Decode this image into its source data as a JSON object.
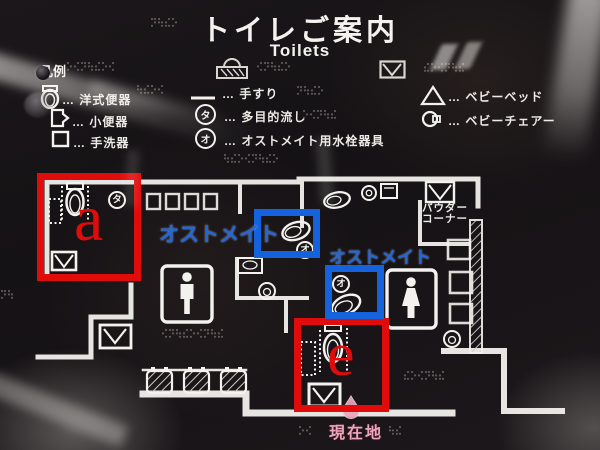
{
  "sign": {
    "title": "トイレご案内",
    "subtitle": "Toilets",
    "legend": {
      "heading": "凡例",
      "left_items": [
        {
          "icon": "western-toilet-icon",
          "label": "… 洋式便器"
        },
        {
          "icon": "urinal-icon",
          "label": "… 小便器"
        },
        {
          "icon": "hand-basin-icon",
          "label": "… 手洗器"
        }
      ],
      "middle_items": [
        {
          "icon": "handrail-icon",
          "label": "… 手すり"
        },
        {
          "icon": "multipurpose-sink-icon",
          "symbol": "タ",
          "label": "… 多目的流し"
        },
        {
          "icon": "ostomate-fixture-icon",
          "symbol": "オ",
          "label": "… オストメイト用水栓器具"
        }
      ],
      "right_items": [
        {
          "icon": "baby-bed-icon",
          "label": "… ベビーベッド"
        },
        {
          "icon": "baby-chair-icon",
          "label": "… ベビーチェアー"
        }
      ]
    },
    "map": {
      "powder_corner_line1": "パウダー",
      "powder_corner_line2": "コーナー",
      "current_location": "現在地",
      "symbol_ta": "タ",
      "symbol_o": "オ"
    }
  },
  "annotations": {
    "box_a_label": "a",
    "box_e_label": "e",
    "ostomate_label_1": "オストメイト",
    "ostomate_label_2": "オストメイト"
  },
  "colors": {
    "annotation_red": "#e00c0c",
    "annotation_blue": "#1463dc",
    "location_pink": "#eba6bc",
    "sign_white": "#f3f2ee"
  }
}
